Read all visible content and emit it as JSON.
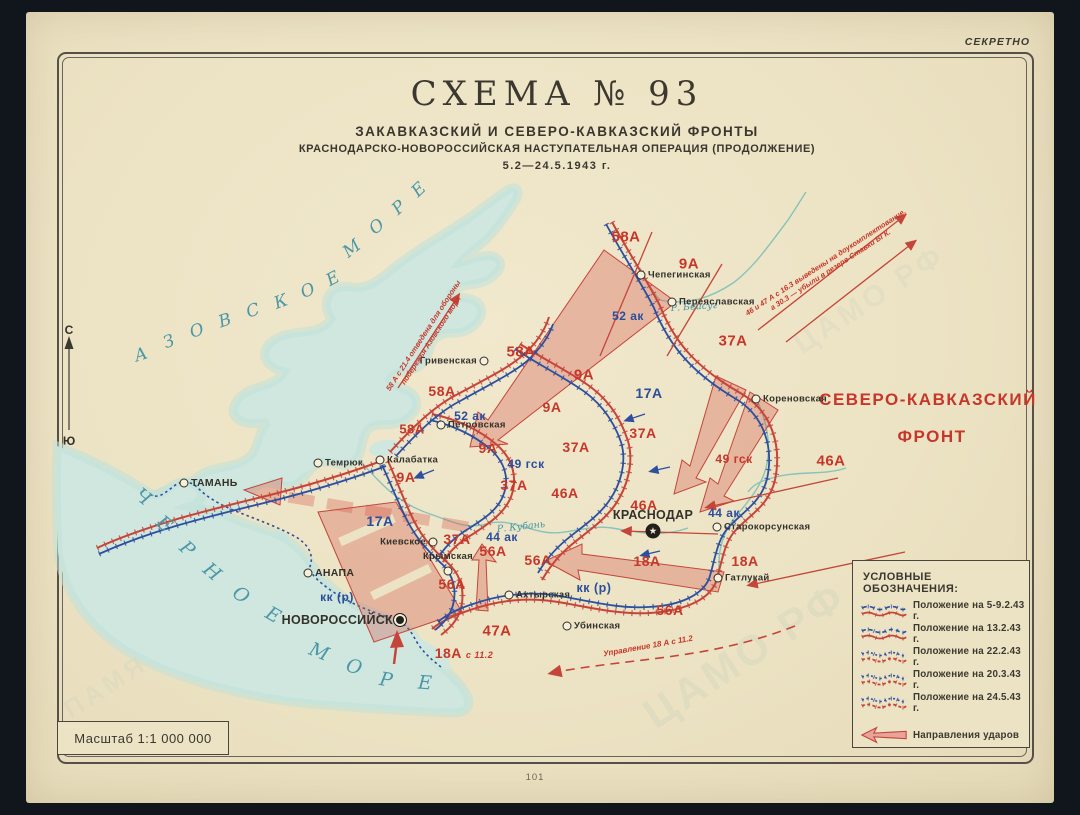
{
  "page": {
    "secret": "СЕКРЕТНО",
    "page_number": "101"
  },
  "title": {
    "scheme": "СХЕМА № 93",
    "line1": "ЗАКАВКАЗСКИЙ И СЕВЕРО-КАВКАЗСКИЙ ФРОНТЫ",
    "line2": "КРАСНОДАРСКО-НОВОРОССИЙСКАЯ НАСТУПАТЕЛЬНАЯ ОПЕРАЦИЯ (ПРОДОЛЖЕНИЕ)",
    "line3": "5.2—24.5.1943 г."
  },
  "front_label": {
    "line1": "СЕВЕРО-КАВКАЗСКИЙ",
    "line2": "ФРОНТ"
  },
  "compass": {
    "north": "С",
    "south": "Ю"
  },
  "scale": {
    "label": "Масштаб 1:1 000 000"
  },
  "legend": {
    "title": "УСЛОВНЫЕ ОБОЗНАЧЕНИЯ:",
    "items": [
      {
        "label": "Положение на 5-9.2.43 г."
      },
      {
        "label": "Положение на 13.2.43 г."
      },
      {
        "label": "Положение на 22.2.43 г."
      },
      {
        "label": "Положение на 20.3.43 г."
      },
      {
        "label": "Положение на 24.5.43 г."
      }
    ],
    "arrow_label": "Направления ударов"
  },
  "seas": [
    {
      "name": "АЗОВСКОЕ МОРЕ"
    },
    {
      "name": "ЧЕРНОЕ МОРЕ"
    }
  ],
  "rivers": [
    {
      "name": "Р. Бейсуг",
      "x": 694,
      "y": 307,
      "rot": -4
    },
    {
      "name": "Р. Кубань",
      "x": 521,
      "y": 527,
      "rot": -6
    }
  ],
  "cities": [
    {
      "name": "Чепегинская",
      "x": 641,
      "y": 275,
      "dot": "ring",
      "side": "right"
    },
    {
      "name": "Переяславская",
      "x": 672,
      "y": 302,
      "dot": "ring",
      "side": "right"
    },
    {
      "name": "Гривенская",
      "x": 484,
      "y": 361,
      "dot": "ring",
      "side": "left"
    },
    {
      "name": "Петровская",
      "x": 441,
      "y": 425,
      "dot": "ring",
      "side": "right"
    },
    {
      "name": "Темрюк",
      "x": 318,
      "y": 463,
      "dot": "ring",
      "side": "right"
    },
    {
      "name": "Калабатка",
      "x": 380,
      "y": 460,
      "dot": "ring",
      "side": "right"
    },
    {
      "name": "ТАМАНЬ",
      "x": 184,
      "y": 483,
      "dot": "ring",
      "side": "right",
      "big": true
    },
    {
      "name": "Киевское",
      "x": 433,
      "y": 542,
      "dot": "ring",
      "side": "left"
    },
    {
      "name": "АНАПА",
      "x": 308,
      "y": 573,
      "dot": "ring",
      "side": "right",
      "big": true
    },
    {
      "name": "Крымская",
      "x": 448,
      "y": 571,
      "dot": "ring",
      "side": "above"
    },
    {
      "name": "Ахтырская",
      "x": 509,
      "y": 595,
      "dot": "ring",
      "side": "right"
    },
    {
      "name": "Убинская",
      "x": 567,
      "y": 626,
      "dot": "ring",
      "side": "right"
    },
    {
      "name": "НОВОРОССИЙСК",
      "x": 400,
      "y": 620,
      "dot": "big",
      "side": "left",
      "big": true
    },
    {
      "name": "Кореновская",
      "x": 756,
      "y": 399,
      "dot": "ring",
      "side": "right"
    },
    {
      "name": "КРАСНОДАР",
      "x": 653,
      "y": 531,
      "dot": "star",
      "side": "above",
      "big": true
    },
    {
      "name": "Старокорсунская",
      "x": 717,
      "y": 527,
      "dot": "ring",
      "side": "right"
    },
    {
      "name": "Гатлукай",
      "x": 718,
      "y": 578,
      "dot": "ring",
      "side": "right"
    }
  ],
  "units": [
    {
      "t": "58А",
      "x": 626,
      "y": 237,
      "c": "red",
      "s": 15
    },
    {
      "t": "9А",
      "x": 689,
      "y": 264,
      "c": "red",
      "s": 15
    },
    {
      "t": "52 ак",
      "x": 628,
      "y": 316,
      "c": "blue",
      "s": 12
    },
    {
      "t": "37А",
      "x": 733,
      "y": 341,
      "c": "red",
      "s": 15
    },
    {
      "t": "58А",
      "x": 521,
      "y": 352,
      "c": "red",
      "s": 15
    },
    {
      "t": "9А",
      "x": 584,
      "y": 375,
      "c": "red",
      "s": 15
    },
    {
      "t": "58А",
      "x": 442,
      "y": 391,
      "c": "red",
      "s": 14
    },
    {
      "t": "17А",
      "x": 649,
      "y": 393,
      "c": "blue",
      "s": 14
    },
    {
      "t": "9А",
      "x": 552,
      "y": 407,
      "c": "red",
      "s": 14
    },
    {
      "t": "52 ак",
      "x": 470,
      "y": 416,
      "c": "blue",
      "s": 12
    },
    {
      "t": "58А",
      "x": 412,
      "y": 429,
      "c": "red",
      "s": 13
    },
    {
      "t": "37А",
      "x": 643,
      "y": 433,
      "c": "red",
      "s": 14
    },
    {
      "t": "9А",
      "x": 488,
      "y": 448,
      "c": "red",
      "s": 14
    },
    {
      "t": "37А",
      "x": 576,
      "y": 447,
      "c": "red",
      "s": 14
    },
    {
      "t": "49 гск",
      "x": 526,
      "y": 464,
      "c": "blue",
      "s": 12
    },
    {
      "t": "49 гск",
      "x": 734,
      "y": 459,
      "c": "red",
      "s": 12
    },
    {
      "t": "46А",
      "x": 831,
      "y": 461,
      "c": "red",
      "s": 15
    },
    {
      "t": "9А",
      "x": 406,
      "y": 477,
      "c": "red",
      "s": 14
    },
    {
      "t": "37А",
      "x": 514,
      "y": 485,
      "c": "red",
      "s": 14
    },
    {
      "t": "46А",
      "x": 565,
      "y": 493,
      "c": "red",
      "s": 14
    },
    {
      "t": "46А",
      "x": 644,
      "y": 505,
      "c": "red",
      "s": 14
    },
    {
      "t": "44 ак",
      "x": 724,
      "y": 513,
      "c": "blue",
      "s": 12
    },
    {
      "t": "17А",
      "x": 380,
      "y": 521,
      "c": "blue",
      "s": 14
    },
    {
      "t": "44 ак",
      "x": 502,
      "y": 537,
      "c": "blue",
      "s": 12
    },
    {
      "t": "37А",
      "x": 457,
      "y": 539,
      "c": "red",
      "s": 14
    },
    {
      "t": "56А",
      "x": 493,
      "y": 551,
      "c": "red",
      "s": 14
    },
    {
      "t": "56А",
      "x": 538,
      "y": 560,
      "c": "red",
      "s": 14
    },
    {
      "t": "18А",
      "x": 647,
      "y": 561,
      "c": "red",
      "s": 14
    },
    {
      "t": "18А",
      "x": 745,
      "y": 561,
      "c": "red",
      "s": 14
    },
    {
      "t": "56А",
      "x": 452,
      "y": 584,
      "c": "red",
      "s": 14
    },
    {
      "t": "кк (р)",
      "x": 594,
      "y": 588,
      "c": "blue",
      "s": 12.5
    },
    {
      "t": "кк (р)",
      "x": 337,
      "y": 597,
      "c": "blue",
      "s": 12
    },
    {
      "t": "56А",
      "x": 670,
      "y": 610,
      "c": "red",
      "s": 14
    },
    {
      "t": "47А",
      "x": 497,
      "y": 631,
      "c": "red",
      "s": 15
    },
    {
      "t": "18А",
      "x": 464,
      "y": 653,
      "c": "red",
      "s": 14,
      "suffix": "с 11.2"
    }
  ],
  "annotations": [
    {
      "lines": [
        "58 А с 21.4 отведена для обороны",
        "побережья Азовского моря"
      ],
      "x": 427,
      "y": 338,
      "rot": -57,
      "size": 7.5
    },
    {
      "lines": [
        "46 и 47 А с 16.3 выведены на доукомплектование,",
        "а 30.3 — убыли в резерв Ставки ВГК."
      ],
      "x": 828,
      "y": 266,
      "rot": -33,
      "size": 7.5
    },
    {
      "lines": [
        "Управление 18 А с 11.2"
      ],
      "x": 648,
      "y": 646,
      "rot": -10,
      "size": 8
    }
  ],
  "watermarks": [
    "ЦАМО РФ",
    "ПАМЯТЬ НАРОДА",
    "ЦАМО РФ"
  ],
  "colors": {
    "red": "#c6372a",
    "blue": "#2b4e9c",
    "water": "#cfe7df",
    "teal_text": "#4b97a7"
  }
}
